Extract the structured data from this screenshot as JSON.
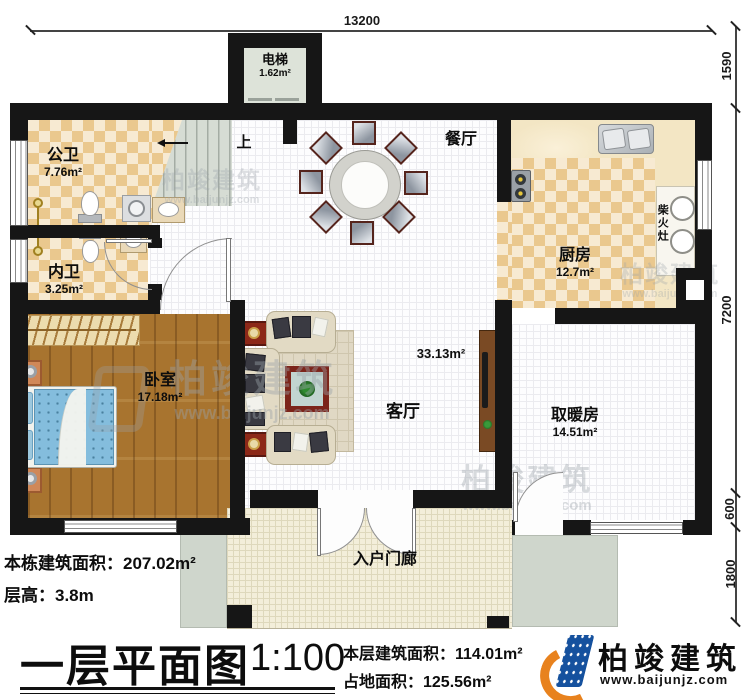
{
  "dim_top": "13200",
  "dims_right": [
    "1590",
    "7200",
    "600",
    "1800"
  ],
  "rooms": {
    "elevator": {
      "name": "电梯",
      "area": "1.62m²"
    },
    "public_bath": {
      "name": "公卫",
      "area": "7.76m²"
    },
    "private_bath": {
      "name": "内卫",
      "area": "3.25m²"
    },
    "bedroom": {
      "name": "卧室",
      "area": "17.18m²"
    },
    "dining": {
      "name": "餐厅"
    },
    "kitchen": {
      "name": "厨房",
      "area": "12.7m²"
    },
    "wood_stove": {
      "name": "柴火灶"
    },
    "living": {
      "name": "客厅",
      "area": "33.13m²"
    },
    "heating": {
      "name": "取暖房",
      "area": "14.51m²"
    },
    "porch": {
      "name": "入户门廊"
    },
    "stairs": {
      "up": "上"
    }
  },
  "notes": {
    "total_area": "本栋建筑面积：207.02m²",
    "floor_height": "层高：3.8m"
  },
  "titleblock": {
    "title": "一层平面图",
    "scale": "1:100",
    "floor_area": "本层建筑面积：114.01m²",
    "footprint": "占地面积：125.56m²"
  },
  "brand": {
    "name": "柏竣建筑",
    "url": "www.baijunjz.com"
  }
}
